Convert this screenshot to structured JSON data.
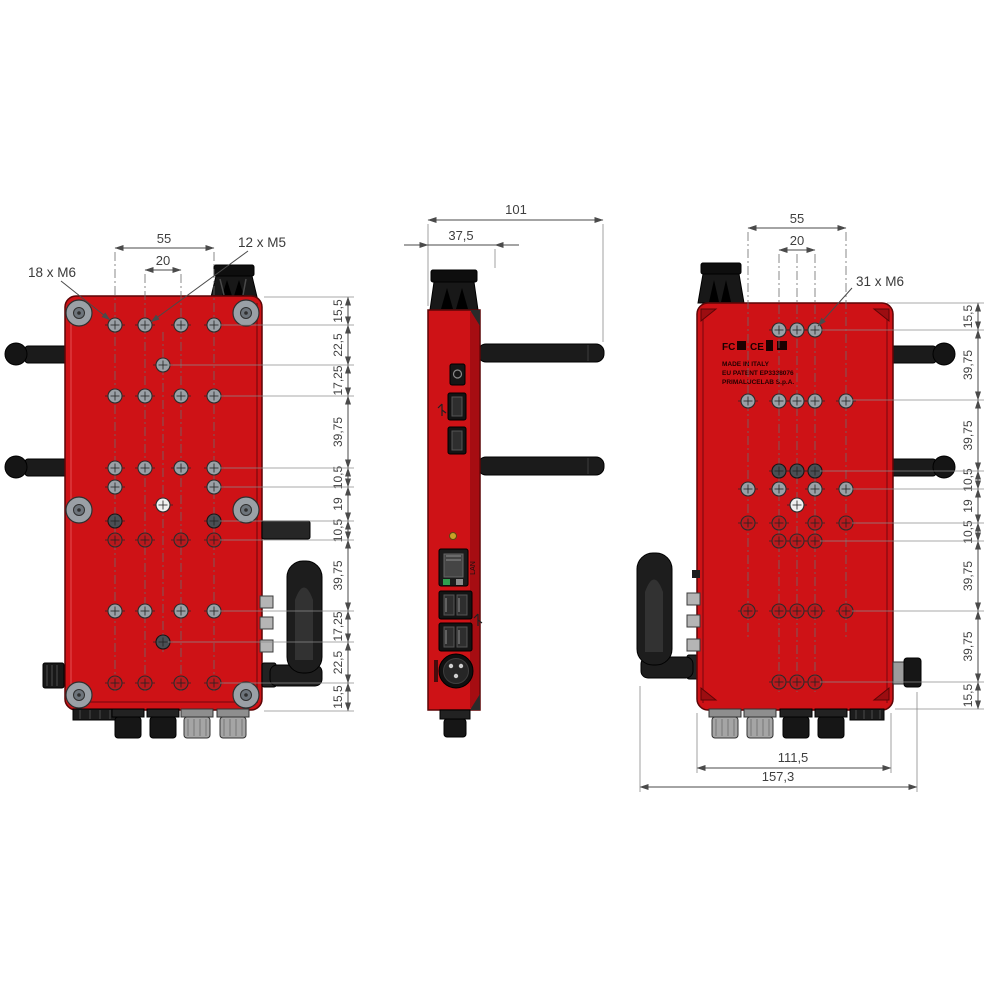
{
  "front_view": {
    "thread_label_left": "18 x M6",
    "thread_label_right": "12 x M5",
    "dim_width_outer": "55",
    "dim_width_inner": "20",
    "dims_vertical": [
      "15,5",
      "22,5",
      "17,25",
      "39,75",
      "10,5",
      "19",
      "10,5",
      "39,75",
      "17,25",
      "22,5",
      "15,5"
    ]
  },
  "side_view": {
    "dim_depth": "101",
    "dim_body": "37,5",
    "lan_label": "LAN"
  },
  "back_view": {
    "thread_label": "31 x M6",
    "dim_width_outer": "55",
    "dim_width_inner": "20",
    "dims_vertical": [
      "15,5",
      "39,75",
      "39,75",
      "10,5",
      "19",
      "10,5",
      "39,75",
      "39,75",
      "15,5"
    ],
    "dim_body_width": "111,5",
    "dim_total_width": "157,3",
    "cert_fcc": "FC",
    "cert_ce": "CE",
    "markings": [
      "MADE IN ITALY",
      "EU PATENT EP3338076",
      "PRIMALUCELAB S.p.A."
    ]
  },
  "colors": {
    "body_red": "#ce1216",
    "body_red_dark": "#8f0b10",
    "body_outline": "#5c0506",
    "part_black": "#1a1a1a",
    "metal_gray": "#9aa0a6",
    "connector_gray": "#a8a8a8",
    "dim_line": "#4a4a4a"
  }
}
